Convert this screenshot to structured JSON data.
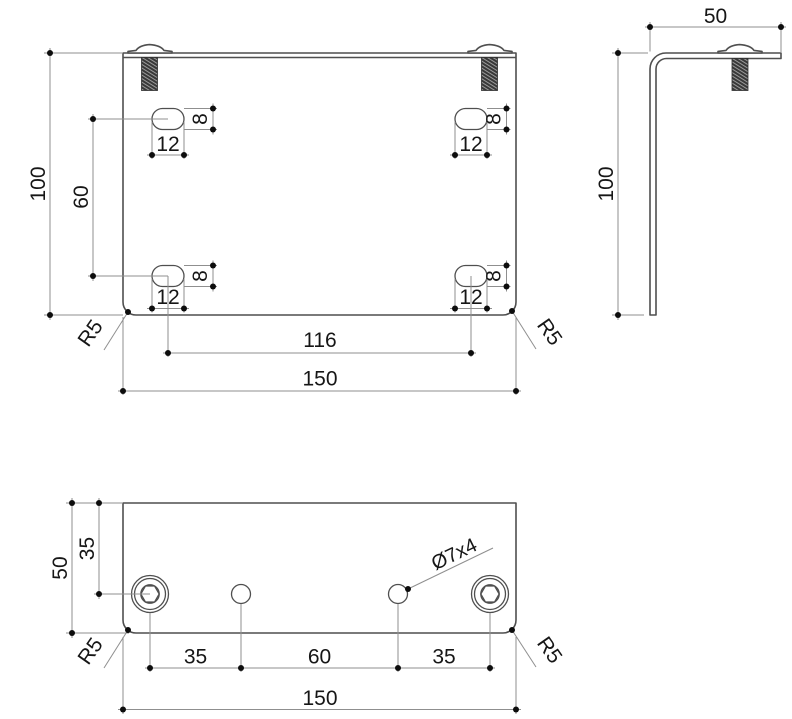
{
  "front_view": {
    "overall_height": "100",
    "slot_row_spacing": "60",
    "slot_width": "12",
    "slot_height": "8",
    "slot_center_spacing": "116",
    "overall_width": "150",
    "corner_radius_left": "R5",
    "corner_radius_right": "R5"
  },
  "side_view": {
    "flange_depth": "50",
    "overall_height": "100"
  },
  "bottom_view": {
    "flange_depth": "50",
    "hole_edge_offset": "35",
    "hole_note": "Ø7x4",
    "hole_pitch_left": "35",
    "hole_pitch_center": "60",
    "hole_pitch_right": "35",
    "overall_width": "150",
    "corner_radius_left": "R5",
    "corner_radius_right": "R5"
  }
}
